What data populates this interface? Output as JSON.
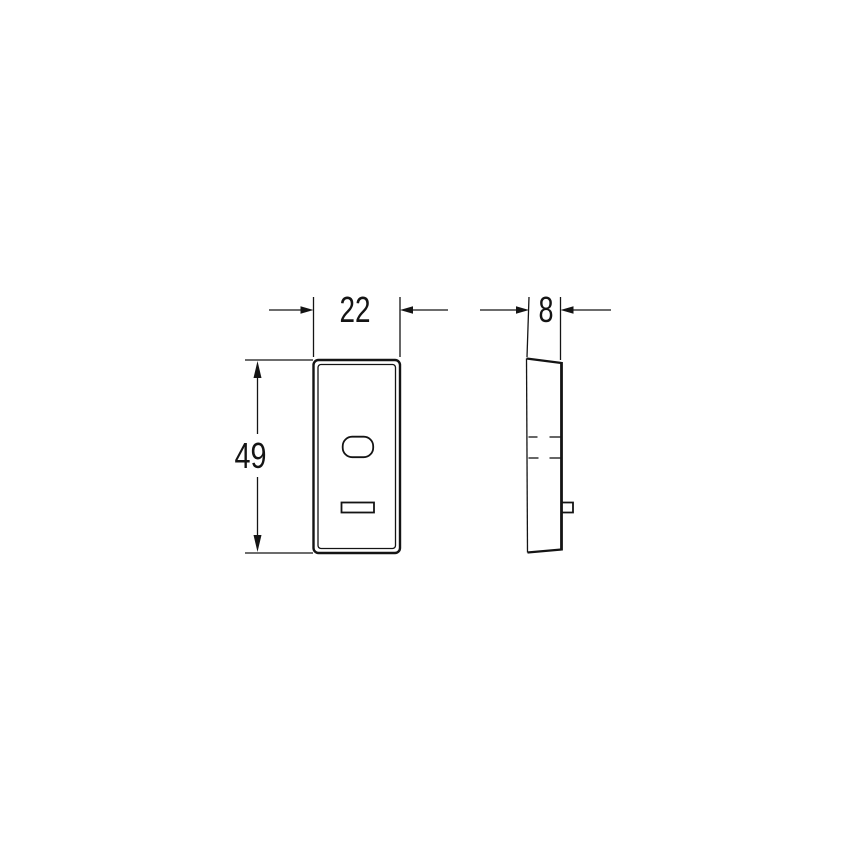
{
  "drawing": {
    "background_color": "#ffffff",
    "line_color": "#141414",
    "dimensions": {
      "width_label": "22",
      "height_label": "49",
      "depth_label": "8"
    }
  }
}
